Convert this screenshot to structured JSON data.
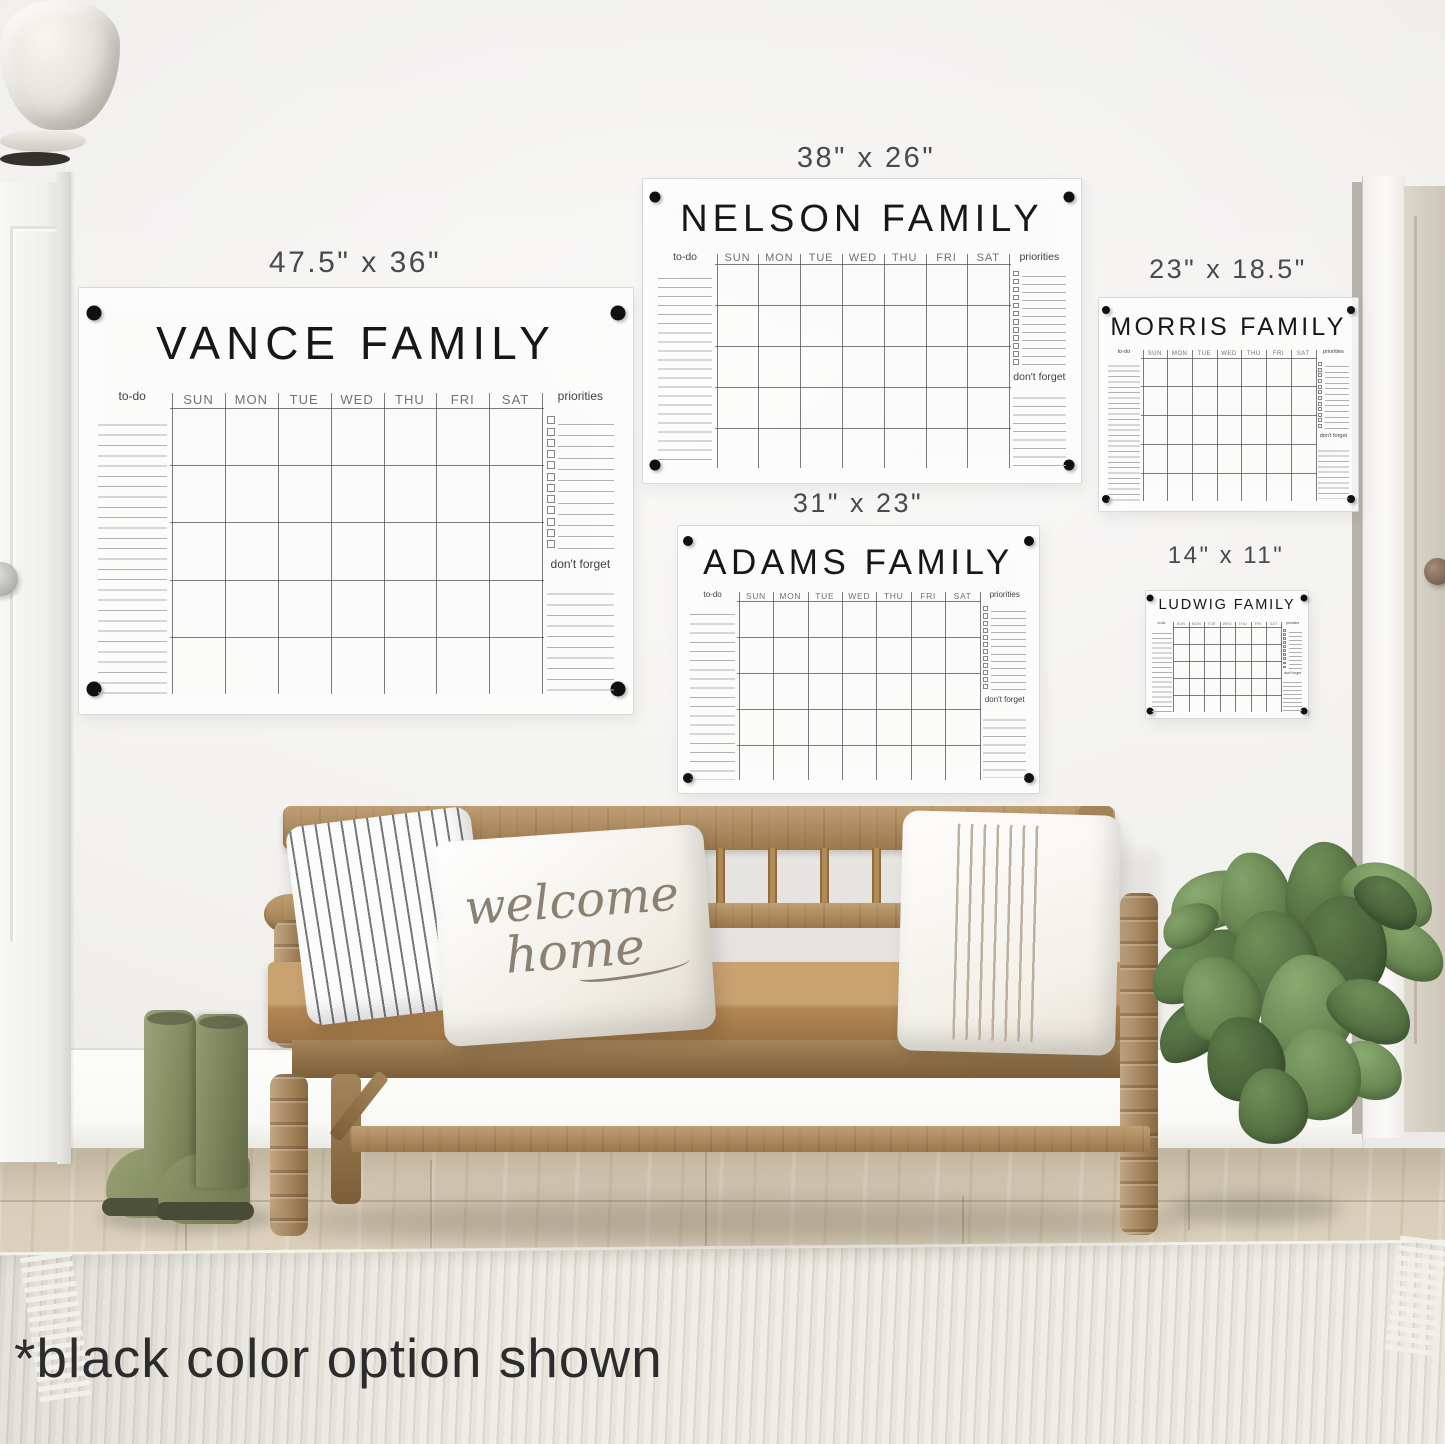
{
  "caption": "*black color option shown",
  "pillow_text": {
    "line1": "welcome",
    "line2": "home"
  },
  "calendar_common": {
    "days": [
      "SUN",
      "MON",
      "TUE",
      "WED",
      "THU",
      "FRI",
      "SAT"
    ],
    "todo_label": "to-do",
    "priorities_label": "priorities",
    "dont_forget_label": "don't forget"
  },
  "boards": [
    {
      "slug": "vance",
      "title": "VANCE FAMILY",
      "size_label": "47.5\" x 36\"",
      "frame": {
        "left": 78,
        "top": 287,
        "width": 554,
        "height": 426
      },
      "size_label_pos": {
        "cx": 355,
        "top": 246,
        "font": 30
      },
      "fonts": {
        "title": 46,
        "day": 13,
        "small": 12
      },
      "title_top_frac": 0.065,
      "todo_lines": 27,
      "priority_rows": 12,
      "forget_lines": 10
    },
    {
      "slug": "nelson",
      "title": "NELSON FAMILY",
      "size_label": "38\" x 26\"",
      "frame": {
        "left": 642,
        "top": 178,
        "width": 438,
        "height": 304
      },
      "size_label_pos": {
        "cx": 866,
        "top": 142,
        "font": 29
      },
      "fonts": {
        "title": 38,
        "day": 11,
        "small": 10.5
      },
      "title_top_frac": 0.062,
      "todo_lines": 22,
      "priority_rows": 12,
      "forget_lines": 9
    },
    {
      "slug": "morris",
      "title": "MORRIS FAMILY",
      "size_label": "23\" x 18.5\"",
      "frame": {
        "left": 1098,
        "top": 297,
        "width": 259,
        "height": 213
      },
      "size_label_pos": {
        "cx": 1228,
        "top": 254,
        "font": 27
      },
      "fonts": {
        "title": 25,
        "day": 6,
        "small": 5.5
      },
      "title_top_frac": 0.072,
      "todo_lines": 26,
      "priority_rows": 12,
      "forget_lines": 10
    },
    {
      "slug": "adams",
      "title": "ADAMS FAMILY",
      "size_label": "31\" x 23\"",
      "frame": {
        "left": 677,
        "top": 525,
        "width": 361,
        "height": 267
      },
      "size_label_pos": {
        "cx": 858,
        "top": 488,
        "font": 27
      },
      "fonts": {
        "title": 35,
        "day": 8.5,
        "small": 8
      },
      "title_top_frac": 0.062,
      "todo_lines": 19,
      "priority_rows": 12,
      "forget_lines": 8
    },
    {
      "slug": "ludwig",
      "title": "LUDWIG FAMILY",
      "size_label": "14\" x 11\"",
      "frame": {
        "left": 1145,
        "top": 590,
        "width": 162,
        "height": 127
      },
      "size_label_pos": {
        "cx": 1226,
        "top": 542,
        "font": 24
      },
      "fonts": {
        "title": 14.5,
        "day": 3.6,
        "small": 3.4
      },
      "title_top_frac": 0.05,
      "todo_lines": 17,
      "priority_rows": 10,
      "forget_lines": 8
    }
  ],
  "colors": {
    "marker_dot": "#101010",
    "grid_line": "#54585b",
    "list_line": "#aeb2b3",
    "title_text": "#171717",
    "day_text": "#6e7275",
    "small_text": "#3e4244",
    "size_label_text": "#4a4a4a",
    "caption_text": "#2c2c2c",
    "boot_green": "#8b9266",
    "wood_brown": "#b48c59",
    "leaf_green": "#648351",
    "pot_white": "#e8e5de"
  }
}
